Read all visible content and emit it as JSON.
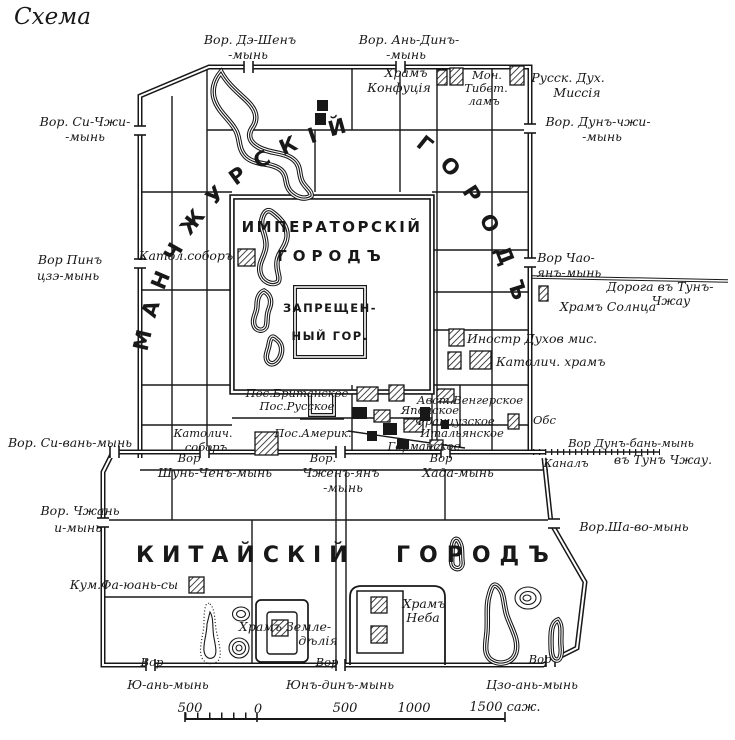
{
  "title": "Схема",
  "city_names": {
    "manchurian_arc1": "МАНЧЖУРСКІЙ",
    "manchurian_arc2": "ГОРОДЪ",
    "imperial_line1": "ИМПЕРАТОРСКІЙ",
    "imperial_line2": "ГОРОДЪ",
    "forbidden_line1": "ЗАПРЕЩЕН-",
    "forbidden_line2": "НЫЙ ГОР.",
    "chinese_line1": "КИТАЙСКІЙ",
    "chinese_line2": "ГОРОДЪ"
  },
  "labels": {
    "gate_de_shen_l1": "Вор. Дэ-Шенъ",
    "gate_de_shen_l2": "-мынь",
    "gate_an_din_l1": "Вор. Ань-Динъ-",
    "gate_an_din_l2": "-мынь",
    "khram_konfutsia_l1": "Храмъ",
    "khram_konfutsia_l2": "Конфуція",
    "mon_tibet_l1": "Мон.",
    "mon_tibet_l2": "Тибет.",
    "mon_tibet_l3": "ламъ",
    "russk_mission_l1": "Русск. Дух.",
    "russk_mission_l2": "Миссія",
    "gate_si_chzhi_l1": "Вор. Си-Чжи-",
    "gate_si_chzhi_l2": "-мынь",
    "gate_dun_chzhi_l1": "Вор. Дунъ-чжи-",
    "gate_dun_chzhi_l2": "-мынь",
    "gate_pin_tsze_l1": "Вор Пинъ",
    "gate_pin_tsze_l2": "цзэ-мынь",
    "katol_sobor_west": "Катол.соборъ",
    "gate_chao_yan_l1": "Вор Чао-",
    "gate_chao_yan_l2": "янъ-мынь",
    "road_tun_chzhau_l1": "Дорога въ Тунъ-",
    "road_tun_chzhau_l2": "Чжау",
    "khram_solntsa": "Храмъ Солнца",
    "inostr_dukhov_mis": "Иностр Духов мис.",
    "katolich_khram": "Католич. храмъ",
    "pos_britanskoe": "Пос.Британское",
    "pos_russkoe": "Пос.Русское",
    "pos_amerik": "Пос.Америк.",
    "katolich_sobor_l1": "Католич.",
    "katolich_sobor_l2": "соборъ",
    "avst_vengerskoe": "Авст.Венгерское",
    "yaponskoe": "Японское",
    "frantsuzskoe": "Французское",
    "italyanskoe": "Итальянское",
    "germanskoe": "Германское",
    "obs": "Обс",
    "gate_dun_ban": "Вор Дунъ-бань-мынь",
    "v_tun_chzhau": "въ Тунъ Чжау.",
    "kanal": "Каналъ",
    "vor_shun_l1": "Вор",
    "vor_shun_l2": "Шунь-Ченъ-мынь",
    "vor_chzhen_l1": "Вор.",
    "vor_chzhen_l2": "Чженъ-янъ",
    "vor_chzhen_l3": "-мынь",
    "vor_khada_l1": "Вор",
    "vor_khada_l2": "Хада-мынь",
    "gate_si_van": "Вор. Си-вань-мынь",
    "gate_chzhan_l1": "Вор. Чжань",
    "gate_chzhan_l2": "и-мынь",
    "gate_sha_vo": "Вор.Ша-во-мынь",
    "kum_fa_yuan_sy": "Кум.Фа-юань-сы",
    "khram_zemledelia_l1": "Храмъ Земле-",
    "khram_zemledelia_l2": "дѣлія",
    "khram_neba_l1": "Храмъ",
    "khram_neba_l2": "Неба",
    "vor_yu_an_l1": "Вор",
    "vor_yu_an_l2": "Ю-ань-мынь",
    "vor_yun_din_l1": "Вор",
    "vor_yun_din_l2": "Юнъ-динъ-мынь",
    "vor_tszo_an_l1": "Вор",
    "vor_tszo_an_l2": "Цзо-ань-мынь"
  },
  "scale_bar": {
    "left_500": "500",
    "zero": "0",
    "mid_500": "500",
    "k1000": "1000",
    "k1500": "1500 саж."
  },
  "colors": {
    "ink": "#181818",
    "paper": "#ffffff"
  }
}
